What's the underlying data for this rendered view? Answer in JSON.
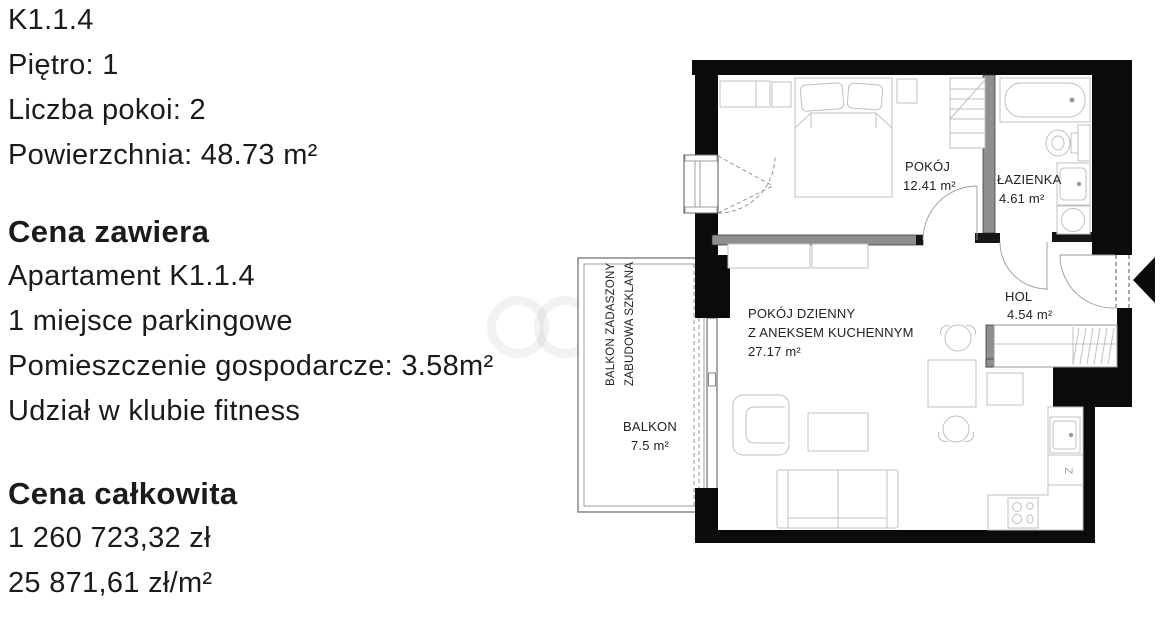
{
  "listing": {
    "unit_id": "K1.1.4",
    "floor_line": "Piętro: 1",
    "rooms_line": "Liczba pokoi: 2",
    "area_line": "Powierzchnia: 48.73 m²",
    "price_includes": {
      "heading": "Cena zawiera",
      "items": [
        "Apartament K1.1.4",
        "1 miejsce parkingowe",
        "Pomieszczenie gospodarcze: 3.58m²",
        "Udział w klubie fitness"
      ]
    },
    "total_price": {
      "heading": "Cena całkowita",
      "total": "1 260 723,32 zł",
      "per_m2": "25 871,61 zł/m²"
    }
  },
  "floorplan": {
    "bedroom": {
      "name": "POKÓJ",
      "area": "12.41 m²"
    },
    "bathroom": {
      "name": "ŁAZIENKA",
      "area": "4.61 m²"
    },
    "hall": {
      "name": "HOL",
      "area": "4.54 m²"
    },
    "living": {
      "name": "POKÓJ DZIENNY",
      "name_line2": "Z ANEKSEM KUCHENNYM",
      "area": "27.17 m²"
    },
    "balcony": {
      "name": "BALKON",
      "area": "7.5 m²",
      "note_line1": "BALKON ZADASZONY",
      "note_line2": "ZABUDOWA SZKLANA"
    },
    "appliance_mark": "Z"
  }
}
